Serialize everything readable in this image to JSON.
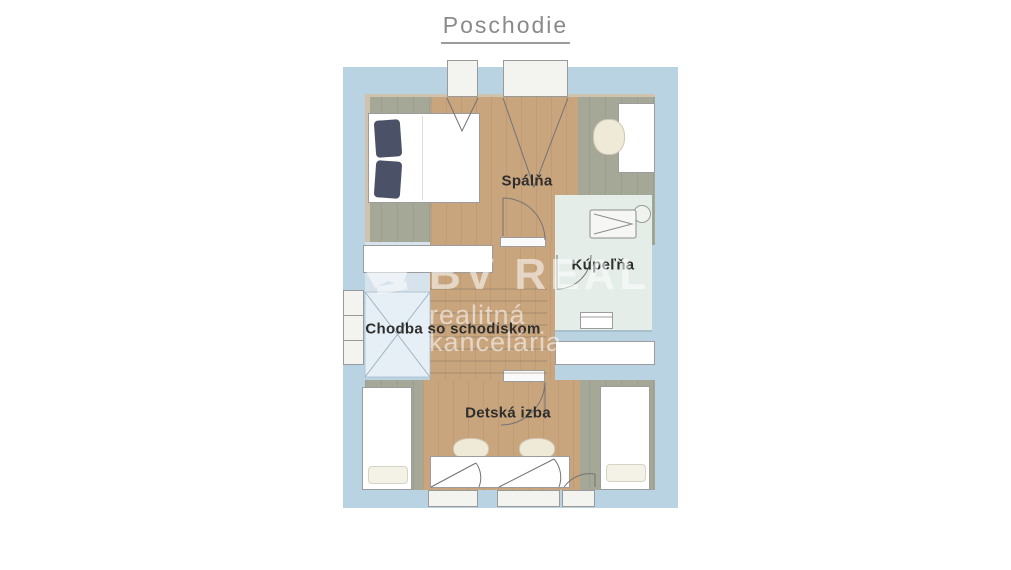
{
  "title": "Poschodie",
  "rooms": {
    "spalna": "Spálňa",
    "kupelna": "Kúpeľňa",
    "chodba": "Chodba so schodiskom",
    "detska": "Detská izba"
  },
  "watermark": {
    "brand": "BV REAL",
    "subtitle": "realitná kancelária"
  },
  "colors": {
    "plan_background": "#b9d3e2",
    "wood_floor": "#c9a57e",
    "sage_floor": "#a5a797",
    "hall_floor": "#d6e3ec",
    "stairwell_floor": "#e6eff5",
    "bathroom_floor": "#e4ede7",
    "wall_beige": "#cfc3ae",
    "furniture_border": "#9c9c9c",
    "pillow_navy": "#4b5166",
    "label_text": "#2e2e2e",
    "title_text": "#8a8a8a",
    "watermark_white": "#ffffff"
  }
}
